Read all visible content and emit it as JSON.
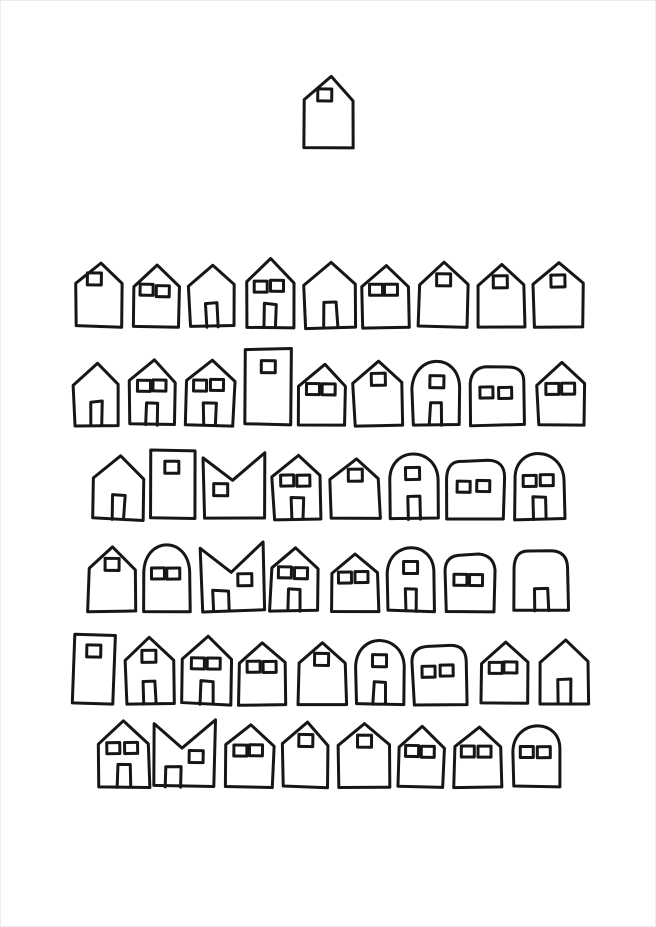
{
  "canvas": {
    "width": 656,
    "height": 927,
    "background": "#ffffff",
    "ink": "#161616",
    "stroke_width": 3,
    "description": "Hand-drawn black ink illustration: rows of small houses with square windows and doors on white paper"
  },
  "top_house": {
    "shape": "pent",
    "x": 303,
    "y": 76,
    "w": 50,
    "h": 70,
    "windows": 1,
    "winSide": "left",
    "door": false
  },
  "rows": [
    {
      "houses": [
        {
          "shape": "pent",
          "x": 75,
          "y": 261,
          "w": 47,
          "h": 65,
          "windows": 1,
          "winSide": "left",
          "door": false
        },
        {
          "shape": "pent",
          "x": 132,
          "y": 264,
          "w": 46,
          "h": 62,
          "windows": 2,
          "winSide": "center",
          "door": false
        },
        {
          "shape": "pent",
          "x": 188,
          "y": 264,
          "w": 45,
          "h": 62,
          "windows": 0,
          "winSide": "center",
          "door": true
        },
        {
          "shape": "pent",
          "x": 245,
          "y": 258,
          "w": 48,
          "h": 68,
          "windows": 2,
          "winSide": "center",
          "door": true
        },
        {
          "shape": "pent",
          "x": 303,
          "y": 261,
          "w": 52,
          "h": 65,
          "windows": 0,
          "winSide": "center",
          "door": true
        },
        {
          "shape": "pent",
          "x": 362,
          "y": 264,
          "w": 45,
          "h": 62,
          "windows": 2,
          "winSide": "center",
          "door": false
        },
        {
          "shape": "pent",
          "x": 418,
          "y": 262,
          "w": 49,
          "h": 64,
          "windows": 1,
          "winSide": "center",
          "door": false
        },
        {
          "shape": "pent",
          "x": 477,
          "y": 264,
          "w": 46,
          "h": 62,
          "windows": 1,
          "winSide": "center",
          "door": false
        },
        {
          "shape": "pent",
          "x": 533,
          "y": 262,
          "w": 49,
          "h": 64,
          "windows": 1,
          "winSide": "center",
          "door": false
        }
      ]
    },
    {
      "houses": [
        {
          "shape": "pent",
          "x": 73,
          "y": 362,
          "w": 45,
          "h": 62,
          "windows": 0,
          "winSide": "center",
          "door": true
        },
        {
          "shape": "pent",
          "x": 128,
          "y": 358,
          "w": 47,
          "h": 66,
          "windows": 2,
          "winSide": "center",
          "door": true
        },
        {
          "shape": "pent",
          "x": 185,
          "y": 358,
          "w": 48,
          "h": 66,
          "windows": 2,
          "winSide": "center",
          "door": true
        },
        {
          "shape": "rect",
          "x": 243,
          "y": 348,
          "w": 47,
          "h": 76,
          "windows": 1,
          "winSide": "center",
          "door": false
        },
        {
          "shape": "pent",
          "x": 298,
          "y": 364,
          "w": 47,
          "h": 60,
          "windows": 2,
          "winSide": "center",
          "door": false
        },
        {
          "shape": "pent",
          "x": 353,
          "y": 360,
          "w": 49,
          "h": 64,
          "windows": 1,
          "winSide": "center",
          "door": false
        },
        {
          "shape": "arch",
          "x": 412,
          "y": 360,
          "w": 46,
          "h": 64,
          "windows": 1,
          "winSide": "center",
          "door": true
        },
        {
          "shape": "rounded",
          "x": 470,
          "y": 366,
          "w": 53,
          "h": 58,
          "windows": 2,
          "winSide": "center",
          "door": false
        },
        {
          "shape": "pent",
          "x": 537,
          "y": 362,
          "w": 46,
          "h": 62,
          "windows": 2,
          "winSide": "center",
          "door": false
        }
      ]
    },
    {
      "houses": [
        {
          "shape": "pent",
          "x": 93,
          "y": 456,
          "w": 49,
          "h": 62,
          "windows": 0,
          "winSide": "center",
          "door": true
        },
        {
          "shape": "rect",
          "x": 150,
          "y": 450,
          "w": 43,
          "h": 68,
          "windows": 1,
          "winSide": "center",
          "door": false
        },
        {
          "shape": "m",
          "x": 203,
          "y": 452,
          "w": 60,
          "h": 66,
          "windows": 1,
          "winSide": "left",
          "door": false
        },
        {
          "shape": "pent",
          "x": 272,
          "y": 454,
          "w": 48,
          "h": 64,
          "windows": 2,
          "winSide": "center",
          "door": true
        },
        {
          "shape": "pent",
          "x": 330,
          "y": 458,
          "w": 48,
          "h": 60,
          "windows": 1,
          "winSide": "center",
          "door": false
        },
        {
          "shape": "arch",
          "x": 388,
          "y": 452,
          "w": 49,
          "h": 66,
          "windows": 1,
          "winSide": "center",
          "door": true
        },
        {
          "shape": "rounded",
          "x": 445,
          "y": 460,
          "w": 58,
          "h": 58,
          "windows": 2,
          "winSide": "center",
          "door": false
        },
        {
          "shape": "arch",
          "x": 513,
          "y": 452,
          "w": 50,
          "h": 66,
          "windows": 2,
          "winSide": "center",
          "door": true
        }
      ]
    },
    {
      "houses": [
        {
          "shape": "pent",
          "x": 87,
          "y": 546,
          "w": 48,
          "h": 64,
          "windows": 1,
          "winSide": "center",
          "door": false
        },
        {
          "shape": "arch",
          "x": 143,
          "y": 544,
          "w": 45,
          "h": 66,
          "windows": 2,
          "winSide": "center",
          "door": false
        },
        {
          "shape": "m",
          "x": 200,
          "y": 542,
          "w": 62,
          "h": 68,
          "windows": 1,
          "winSide": "right",
          "door": true
        },
        {
          "shape": "pent",
          "x": 270,
          "y": 546,
          "w": 47,
          "h": 64,
          "windows": 2,
          "winSide": "center",
          "door": true
        },
        {
          "shape": "pent",
          "x": 330,
          "y": 552,
          "w": 47,
          "h": 58,
          "windows": 2,
          "winSide": "center",
          "door": false
        },
        {
          "shape": "arch",
          "x": 387,
          "y": 546,
          "w": 46,
          "h": 64,
          "windows": 1,
          "winSide": "center",
          "door": true
        },
        {
          "shape": "rounded",
          "x": 445,
          "y": 554,
          "w": 48,
          "h": 56,
          "windows": 2,
          "winSide": "center",
          "door": false
        },
        {
          "shape": "rounded",
          "x": 513,
          "y": 550,
          "w": 54,
          "h": 60,
          "windows": 0,
          "winSide": "center",
          "door": true
        }
      ]
    },
    {
      "houses": [
        {
          "shape": "rect",
          "x": 72,
          "y": 633,
          "w": 41,
          "h": 70,
          "windows": 1,
          "winSide": "center",
          "door": false
        },
        {
          "shape": "pent",
          "x": 125,
          "y": 637,
          "w": 47,
          "h": 66,
          "windows": 1,
          "winSide": "center",
          "door": true
        },
        {
          "shape": "pent",
          "x": 182,
          "y": 635,
          "w": 48,
          "h": 68,
          "windows": 2,
          "winSide": "center",
          "door": true
        },
        {
          "shape": "pent",
          "x": 238,
          "y": 641,
          "w": 47,
          "h": 62,
          "windows": 2,
          "winSide": "center",
          "door": false
        },
        {
          "shape": "pent",
          "x": 297,
          "y": 641,
          "w": 48,
          "h": 62,
          "windows": 1,
          "winSide": "center",
          "door": false
        },
        {
          "shape": "arch",
          "x": 355,
          "y": 639,
          "w": 47,
          "h": 64,
          "windows": 1,
          "winSide": "center",
          "door": true
        },
        {
          "shape": "rounded",
          "x": 412,
          "y": 645,
          "w": 53,
          "h": 58,
          "windows": 2,
          "winSide": "center",
          "door": false
        },
        {
          "shape": "pent",
          "x": 480,
          "y": 641,
          "w": 47,
          "h": 62,
          "windows": 2,
          "winSide": "center",
          "door": false
        },
        {
          "shape": "pent",
          "x": 538,
          "y": 639,
          "w": 50,
          "h": 64,
          "windows": 0,
          "winSide": "center",
          "door": true
        }
      ]
    },
    {
      "houses": [
        {
          "shape": "pent",
          "x": 97,
          "y": 720,
          "w": 51,
          "h": 66,
          "windows": 2,
          "winSide": "center",
          "door": true
        },
        {
          "shape": "m",
          "x": 153,
          "y": 719,
          "w": 60,
          "h": 67,
          "windows": 1,
          "winSide": "right",
          "door": true
        },
        {
          "shape": "pent",
          "x": 225,
          "y": 724,
          "w": 47,
          "h": 62,
          "windows": 2,
          "winSide": "center",
          "door": false
        },
        {
          "shape": "pent",
          "x": 282,
          "y": 722,
          "w": 46,
          "h": 64,
          "windows": 1,
          "winSide": "center",
          "door": false
        },
        {
          "shape": "pent",
          "x": 338,
          "y": 722,
          "w": 50,
          "h": 64,
          "windows": 1,
          "winSide": "center",
          "door": false
        },
        {
          "shape": "pent",
          "x": 397,
          "y": 726,
          "w": 46,
          "h": 60,
          "windows": 2,
          "winSide": "center",
          "door": false
        },
        {
          "shape": "pent",
          "x": 453,
          "y": 726,
          "w": 47,
          "h": 60,
          "windows": 2,
          "winSide": "center",
          "door": false
        },
        {
          "shape": "arch",
          "x": 512,
          "y": 724,
          "w": 48,
          "h": 62,
          "windows": 2,
          "winSide": "center",
          "door": false
        }
      ]
    }
  ]
}
